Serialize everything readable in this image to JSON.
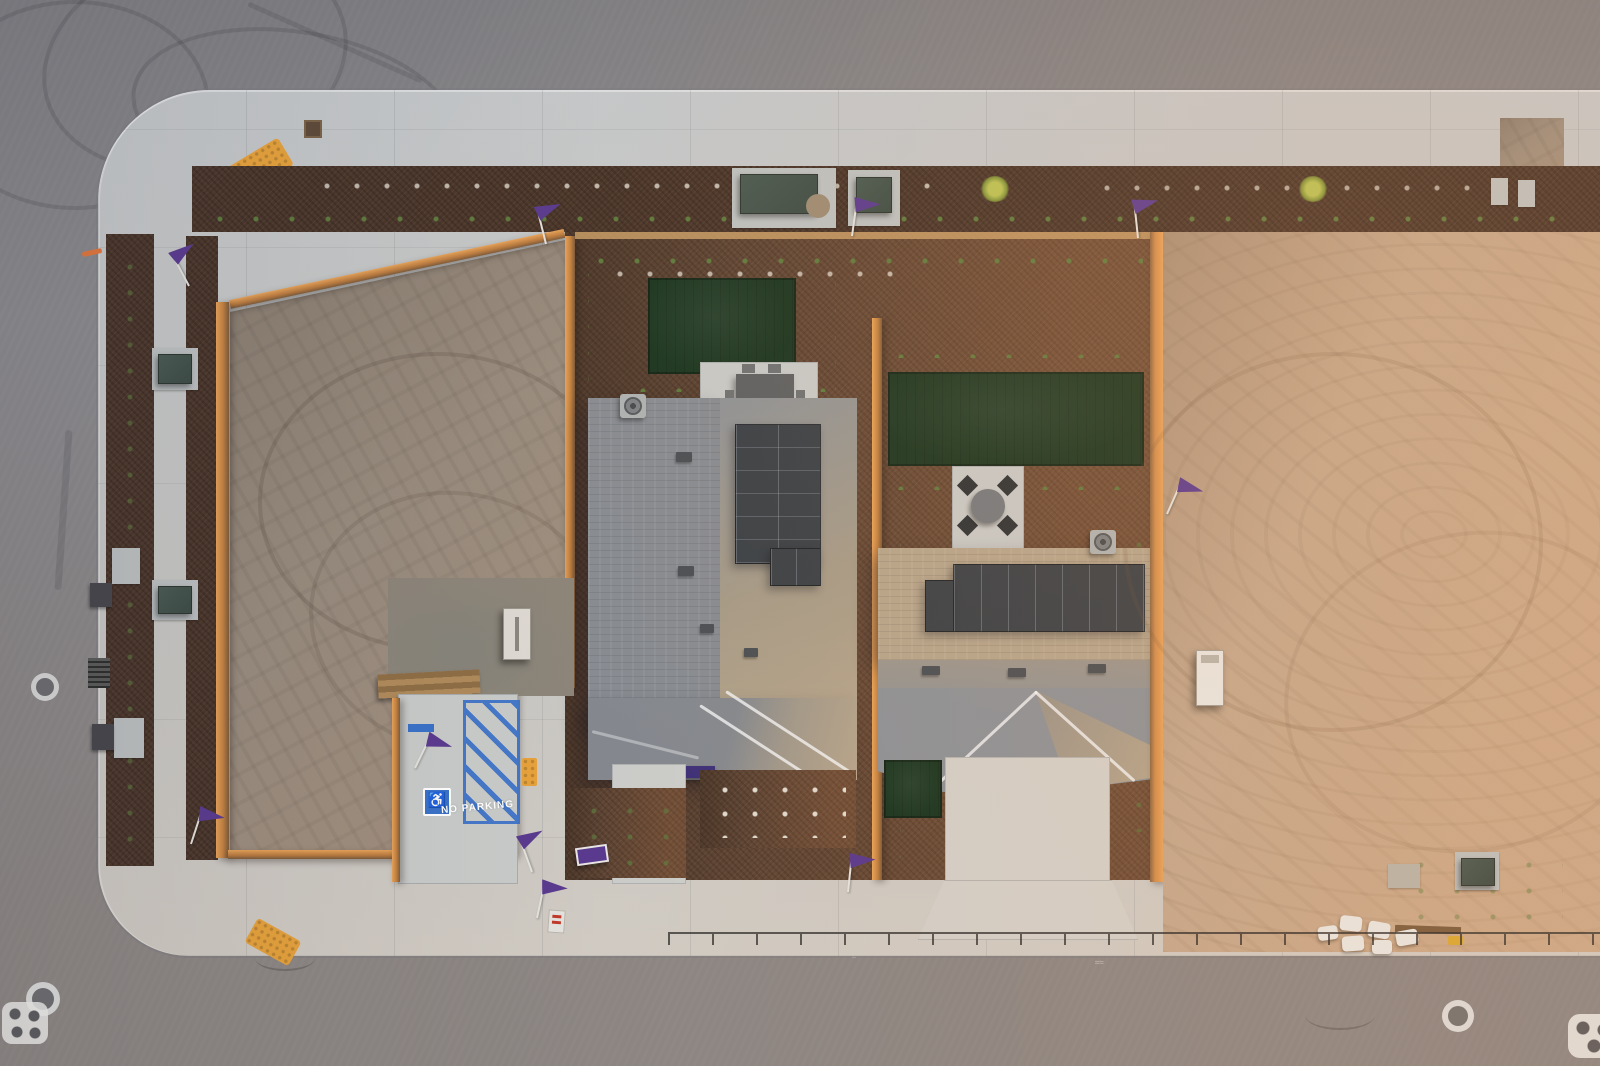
{
  "scene": {
    "type": "aerial-drone-photo",
    "description": "Golden-hour top-down drone view of a new-home model complex: two houses with rooftop solar panels and landscaped yards between two graded dirt lots, wrapped by fresh concrete sidewalks, dark mulch planting strips and asphalt streets.",
    "lighting": "low sun from the right casting warm light on wood fences and roof slopes"
  },
  "labels": {
    "no_parking": "NO PARKING",
    "handicap_symbol": "♿",
    "road_paint_measure": "2111.09→",
    "road_paint_number": "450"
  },
  "features": {
    "houses": 2,
    "solar_arrays": 2,
    "turf_lawns": 3,
    "marketing_flags": 10,
    "dirt_lots": 2
  },
  "colors": {
    "asphalt": "#8a898c",
    "concrete": "#c4c7c9",
    "concrete_warm": "#d0cac2",
    "mulch": "#4a3529",
    "mulch_warm": "#5e4433",
    "dirt_left": "#998c7e",
    "dirt_right": "#c3a78c",
    "fence_lit": "#e8a359",
    "fence_dark": "#7c5a3a",
    "roof_gray": "#878b91",
    "roof_sunlit": "#b5a48b",
    "solar": "#3a4046",
    "turf": "#1a3520",
    "flag_purple": "#5a3a8e",
    "awning_purple": "#3f3178",
    "ada_yellow": "#e7a23b",
    "parking_blue": "#3a72c8",
    "utility_green": "#3d4b44",
    "paint_white": "#f2f2ee"
  }
}
